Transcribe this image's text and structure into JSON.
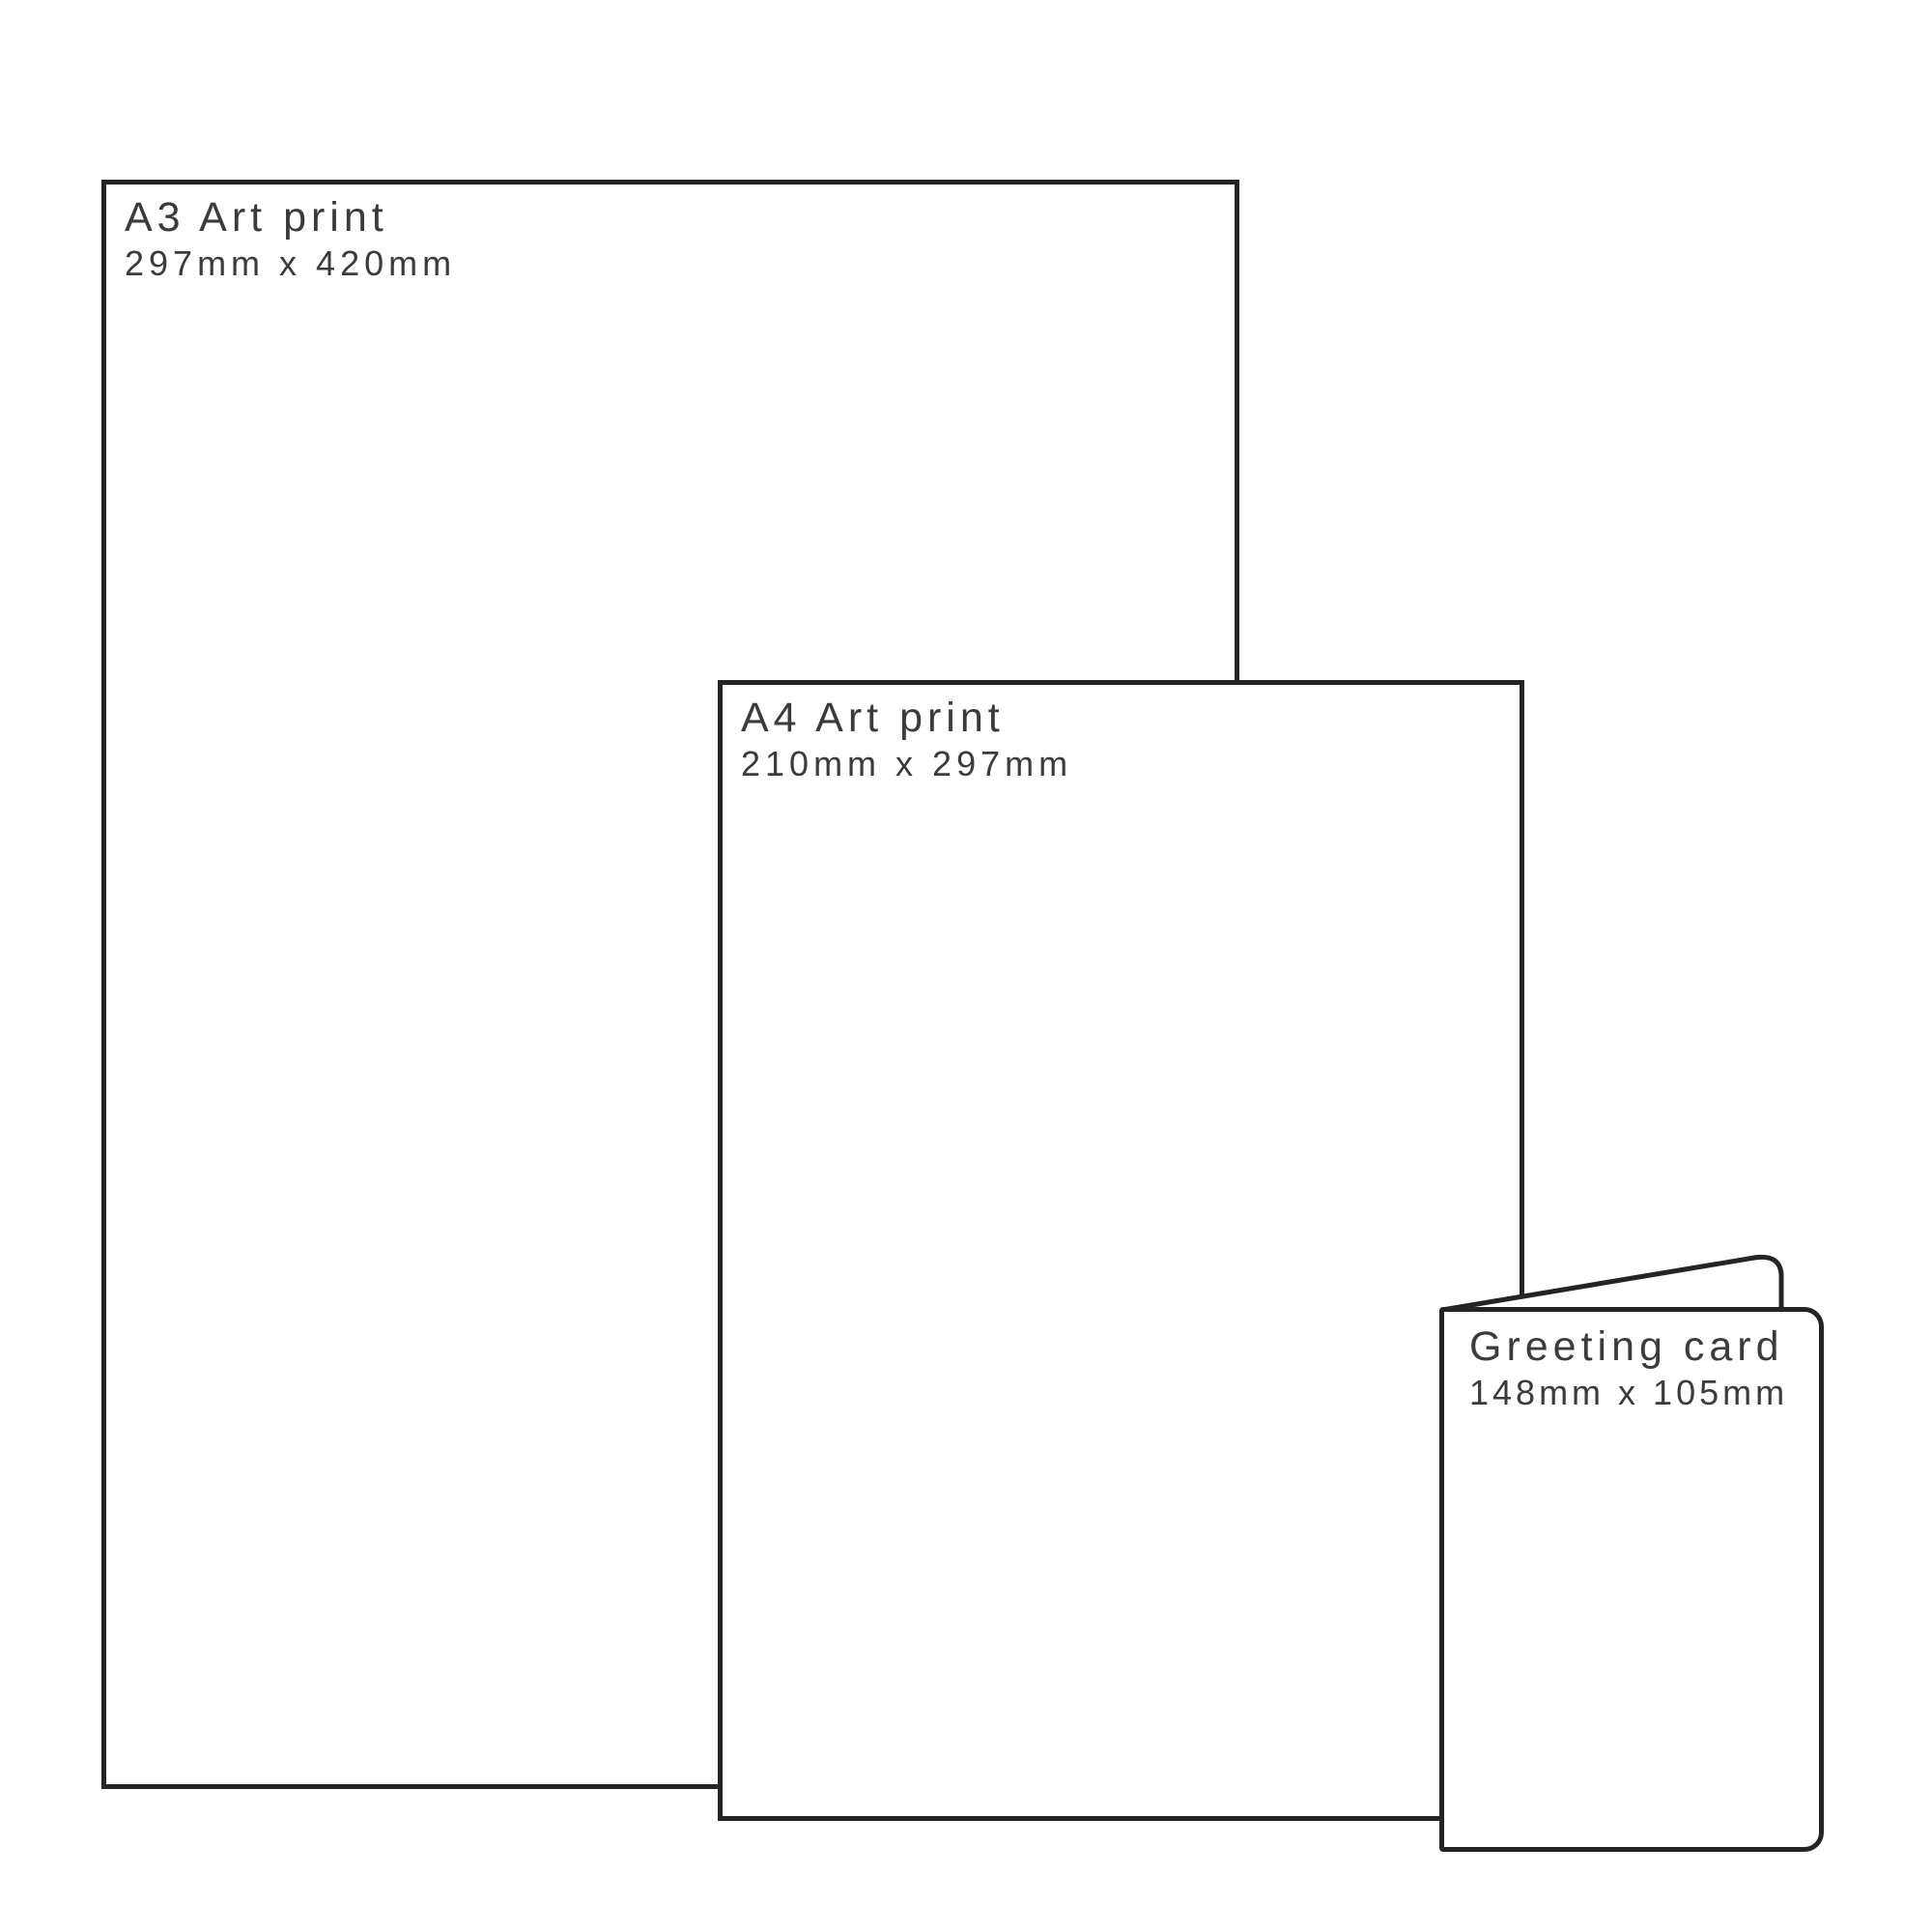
{
  "diagram": {
    "description": "Print size comparison diagram",
    "background_color": "#ffffff",
    "outline_color": "#242424",
    "text_color": "#3b3b3b"
  },
  "prints": [
    {
      "id": "a3",
      "title": "A3 Art print",
      "dimensions": "297mm x 420mm"
    },
    {
      "id": "a4",
      "title": "A4 Art print",
      "dimensions": "210mm x 297mm"
    },
    {
      "id": "card",
      "title": "Greeting card",
      "dimensions": "148mm x 105mm"
    }
  ]
}
